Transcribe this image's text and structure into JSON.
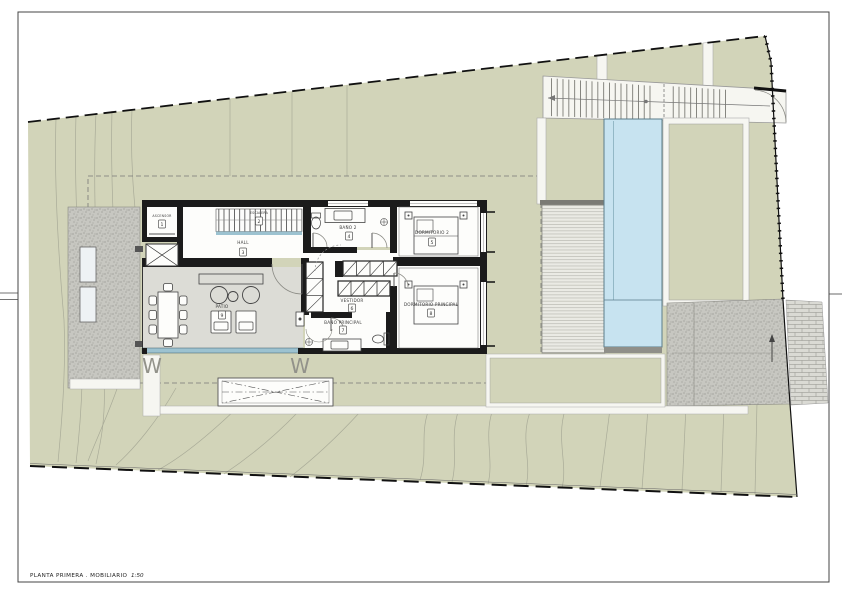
{
  "title_block": {
    "title": "PLANTA PRIMERA . MOBILIARIO",
    "scale": "1:50"
  },
  "rooms": {
    "ascensor": {
      "label": "ASCENSOR",
      "number": "1"
    },
    "escalera": {
      "label": "ESCALERA",
      "number": "2"
    },
    "hall": {
      "label": "HALL",
      "number": "3"
    },
    "bano2": {
      "label": "BAÑO 2",
      "number": "4"
    },
    "dormitorio2": {
      "label": "DORMITORIO 2",
      "number": "5"
    },
    "vestidor": {
      "label": "VESTIDOR",
      "number": "6"
    },
    "bano_principal": {
      "label": "BAÑO PRINCIPAL",
      "number": "7"
    },
    "dormitorio_principal": {
      "label": "DORMITORIO PRINCIPAL",
      "number": "8"
    },
    "patio": {
      "label": "PATIO",
      "number": "9"
    }
  },
  "annotations": {
    "window_marker": "W"
  },
  "colors": {
    "grass": "#d2d4b9",
    "pool": "#c7e3f0",
    "deck": "#eaeae4",
    "patio_floor": "#dcdcd6",
    "wall": "#1b1b1b",
    "path": "#f6f6f1",
    "gravel": "#c7c7c1",
    "brick": "#dadad4",
    "glazing": "#9cc2d0",
    "floor": "#fdfdfb"
  }
}
